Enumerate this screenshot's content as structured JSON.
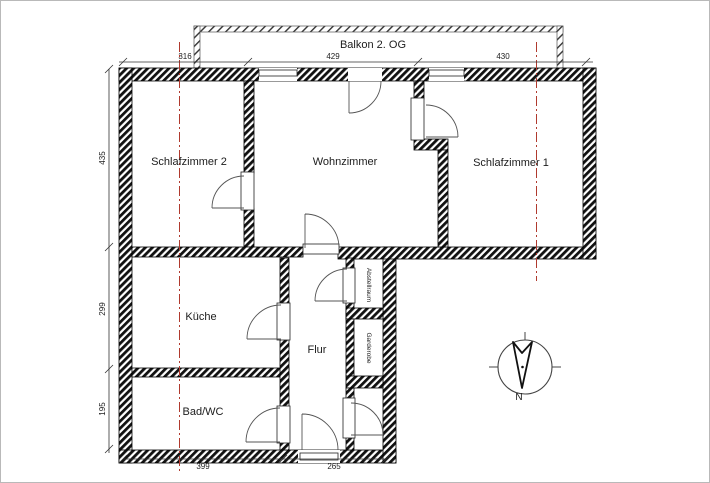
{
  "plan": {
    "balcony_label": "Balkon 2. OG",
    "rooms": {
      "schlafzimmer2": "Schlafzimmer 2",
      "wohnzimmer": "Wohnzimmer",
      "schlafzimmer1": "Schlafzimmer 1",
      "kueche": "Küche",
      "flur": "Flur",
      "bad_wc": "Bad/WC",
      "abstellraum": "Abstellraum",
      "garderobe": "Garderobe"
    },
    "dimensions": {
      "top": {
        "seg1": "316",
        "seg2": "429",
        "seg3": "430"
      },
      "left": {
        "seg1": "435",
        "seg2": "299",
        "seg3": "195"
      },
      "bottom": {
        "seg1": "399",
        "seg2": "265"
      }
    },
    "compass": {
      "north": "N"
    },
    "colors": {
      "wall": "#111111",
      "centerline": "#b03a2e",
      "dimension": "#333333"
    }
  }
}
